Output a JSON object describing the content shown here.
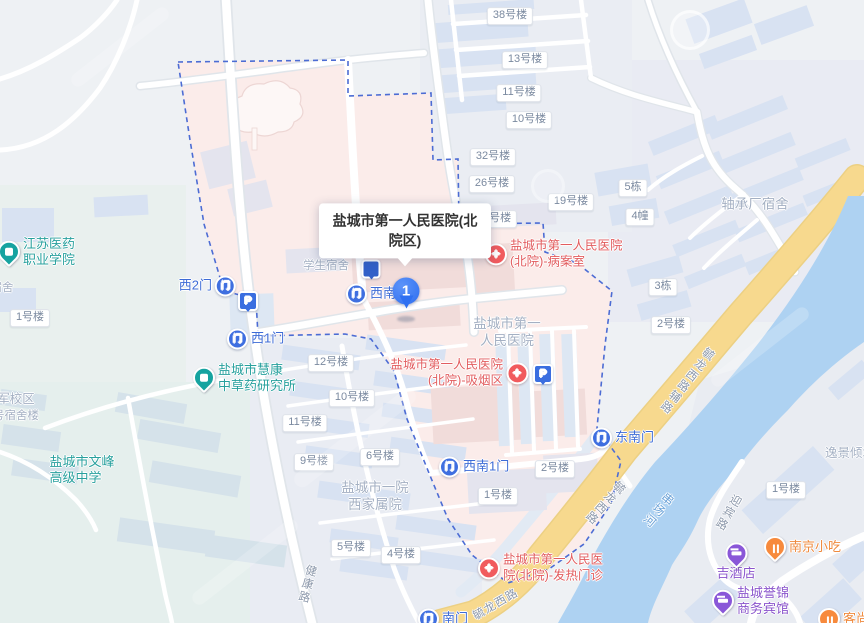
{
  "map": {
    "tooltip": {
      "text": "盐城市第一人民医院(北院区)"
    },
    "marker": {
      "label": "1"
    },
    "icon_glyphs": {
      "gate": "门",
      "hosp": "+",
      "park": "P"
    },
    "colors": {
      "campus_pink": "#fbecea",
      "water_blue": "#aed2f2",
      "road_yellow": "#f7d98e",
      "boundary_blue": "#4c6cd4",
      "marker_blue": "#2f70f1",
      "hospital_red": "#e25d5f",
      "gate_blue": "#3d6bd6",
      "poi_teal": "#16a3a0",
      "hotel_purple": "#8a57d8",
      "food_orange": "#f78a3d",
      "building_blue": "#d8e2f2"
    },
    "labels": [
      {
        "k": "chip",
        "t": "38号楼",
        "x": 510,
        "y": 16,
        "n": "building-label-38"
      },
      {
        "k": "chip",
        "t": "13号楼",
        "x": 525,
        "y": 60,
        "n": "building-label-13"
      },
      {
        "k": "chip",
        "t": "11号楼",
        "x": 519,
        "y": 93,
        "n": "building-label-11n"
      },
      {
        "k": "chip",
        "t": "10号楼",
        "x": 529,
        "y": 120,
        "n": "building-label-10n"
      },
      {
        "k": "chip",
        "t": "32号楼",
        "x": 493,
        "y": 157,
        "n": "building-label-32"
      },
      {
        "k": "chip",
        "t": "26号楼",
        "x": 492,
        "y": 184,
        "n": "building-label-26"
      },
      {
        "k": "chip",
        "t": "18号楼",
        "x": 494,
        "y": 219,
        "n": "building-label-18"
      },
      {
        "k": "chip",
        "t": "19号楼",
        "x": 571,
        "y": 202,
        "n": "building-label-19"
      },
      {
        "k": "chip",
        "t": "5栋",
        "x": 633,
        "y": 188,
        "n": "building-label-d5"
      },
      {
        "k": "chip",
        "t": "4幢",
        "x": 640,
        "y": 217,
        "n": "building-label-d4"
      },
      {
        "k": "chip",
        "t": "3栋",
        "x": 663,
        "y": 287,
        "n": "building-label-d3"
      },
      {
        "k": "chip",
        "t": "2号楼",
        "x": 671,
        "y": 325,
        "n": "building-label-2e"
      },
      {
        "k": "chip",
        "t": "1号楼",
        "x": 786,
        "y": 490,
        "n": "building-label-1se"
      },
      {
        "k": "chip",
        "t": "1号楼",
        "x": 30,
        "y": 318,
        "n": "building-label-1w"
      },
      {
        "k": "chip",
        "t": "12号楼",
        "x": 331,
        "y": 363,
        "n": "building-label-12"
      },
      {
        "k": "chip",
        "t": "10号楼",
        "x": 352,
        "y": 398,
        "n": "building-label-10w"
      },
      {
        "k": "chip",
        "t": "11号楼",
        "x": 305,
        "y": 423,
        "n": "building-label-11w"
      },
      {
        "k": "chip",
        "t": "9号楼",
        "x": 314,
        "y": 462,
        "n": "building-label-9"
      },
      {
        "k": "chip",
        "t": "6号楼",
        "x": 380,
        "y": 457,
        "n": "building-label-6"
      },
      {
        "k": "chip",
        "t": "5号楼",
        "x": 351,
        "y": 548,
        "n": "building-label-5"
      },
      {
        "k": "chip",
        "t": "4号楼",
        "x": 401,
        "y": 555,
        "n": "building-label-4"
      },
      {
        "k": "chip",
        "t": "1号楼",
        "x": 498,
        "y": 496,
        "n": "building-label-1h"
      },
      {
        "k": "chip",
        "t": "2号楼",
        "x": 555,
        "y": 469,
        "n": "building-label-2h"
      },
      {
        "k": "area",
        "t": "学生宿舍",
        "x": 326,
        "y": 266,
        "s": 11.5,
        "n": "student-dorm-label"
      },
      {
        "k": "area",
        "t": "盐城市第一\n人民医院",
        "x": 507,
        "y": 333,
        "s": 13.5,
        "n": "hospital-area-label"
      },
      {
        "k": "area",
        "t": "盐城市一院\n西家属院",
        "x": 375,
        "y": 497,
        "s": 13.5,
        "n": "staff-housing-label"
      },
      {
        "k": "area",
        "t": "轴承厂宿舍",
        "x": 755,
        "y": 205,
        "s": 13.5,
        "n": "bearing-factory-dorm-label"
      },
      {
        "k": "area",
        "t": "逸景倾城",
        "x": 850,
        "y": 454,
        "s": 12.5,
        "n": "yijing-compound-label"
      },
      {
        "k": "area",
        "t": "军校区",
        "x": 16,
        "y": 400,
        "s": 12.5,
        "n": "military-campus-label"
      },
      {
        "k": "area",
        "t": "号宿舍楼",
        "x": 16,
        "y": 416,
        "s": 11.5,
        "n": "dorm-building-label"
      },
      {
        "k": "area",
        "t": "宿舍",
        "x": 2,
        "y": 288,
        "s": 11.5,
        "n": "dorm-label-edge"
      },
      {
        "k": "edu",
        "t": "江苏医药\n职业学院",
        "x": -2,
        "y": 252,
        "n": "jiangsu-medical-college"
      },
      {
        "k": "edu",
        "t": "盐城市慧康\n中草药研究所",
        "x": 193,
        "y": 378,
        "n": "huikang-herbal-institute"
      },
      {
        "k": "edu",
        "t": "盐城市文峰\n高级中学",
        "x": 82,
        "y": 470,
        "icon": false,
        "anch": "c",
        "n": "wenfeng-high-school"
      },
      {
        "k": "hosp",
        "t": "盐城市第一人民医院\n(北院)-病案室",
        "x": 485,
        "y": 254,
        "n": "hospital-records-room"
      },
      {
        "k": "hosp",
        "t": "盐城市第一人民医院\n(北院)-吸烟区",
        "x": 528,
        "y": 373,
        "side": "r",
        "n": "hospital-smoking-area"
      },
      {
        "k": "hosp",
        "t": "盐城市第一人民医\n院(北院)-发热门诊",
        "x": 478,
        "y": 568,
        "n": "hospital-fever-clinic"
      },
      {
        "k": "gate",
        "t": "西2门",
        "x": 236,
        "y": 286,
        "side": "r",
        "n": "gate-west-2"
      },
      {
        "k": "gate",
        "t": "西1门",
        "x": 227,
        "y": 339,
        "n": "gate-west-1"
      },
      {
        "k": "gate",
        "t": "西南门",
        "x": 346,
        "y": 294,
        "n": "gate-southwest"
      },
      {
        "k": "gate",
        "t": "西南1门",
        "x": 439,
        "y": 467,
        "n": "gate-southwest-1"
      },
      {
        "k": "gate",
        "t": "东南门",
        "x": 591,
        "y": 438,
        "n": "gate-southeast"
      },
      {
        "k": "gate",
        "t": "南门",
        "x": 418,
        "y": 619,
        "n": "gate-south-partial"
      },
      {
        "k": "park",
        "t": "",
        "x": 248,
        "y": 301,
        "anch": "c",
        "n": "parking-west"
      },
      {
        "k": "park",
        "t": "",
        "x": 543,
        "y": 374,
        "anch": "c",
        "n": "parking-hospital"
      },
      {
        "k": "hotel",
        "t": "吉酒店",
        "x": 736,
        "y": 562,
        "anch": "v",
        "n": "ji-hotel"
      },
      {
        "k": "hotel",
        "t": "盐城誉锦\n商务宾馆",
        "x": 712,
        "y": 601,
        "n": "yujin-business-hotel"
      },
      {
        "k": "food",
        "t": "南京小吃",
        "x": 764,
        "y": 547,
        "n": "nanjing-snacks"
      },
      {
        "k": "food",
        "t": "客尚",
        "x": 818,
        "y": 619,
        "n": "keshang-partial"
      },
      {
        "k": "pin",
        "t": "",
        "x": 371,
        "y": 269,
        "anch": "c",
        "n": "poi-pin-under-tooltip"
      },
      {
        "k": "road",
        "t": "健康路",
        "x": 306,
        "y": 584,
        "vert": 1,
        "rot": 14,
        "n": "road-label-jiankang"
      },
      {
        "k": "road",
        "t": "毓龙西路辅路",
        "x": 686,
        "y": 380,
        "vert": 1,
        "rot": 38,
        "n": "road-label-yulong-aux"
      },
      {
        "k": "road",
        "t": "毓龙西路",
        "x": 604,
        "y": 502,
        "vert": 1,
        "rot": 42,
        "n": "road-label-yulong-1"
      },
      {
        "k": "road",
        "t": "毓龙西路",
        "x": 496,
        "y": 605,
        "rot": -30,
        "n": "road-label-yulong-2"
      },
      {
        "k": "road",
        "t": "迎宾路",
        "x": 727,
        "y": 512,
        "vert": 1,
        "rot": 30,
        "n": "road-label-yingbin"
      },
      {
        "k": "water",
        "t": "串场河",
        "x": 658,
        "y": 510,
        "vert": 1,
        "rot": 40,
        "n": "river-label-chuanchang"
      }
    ]
  }
}
